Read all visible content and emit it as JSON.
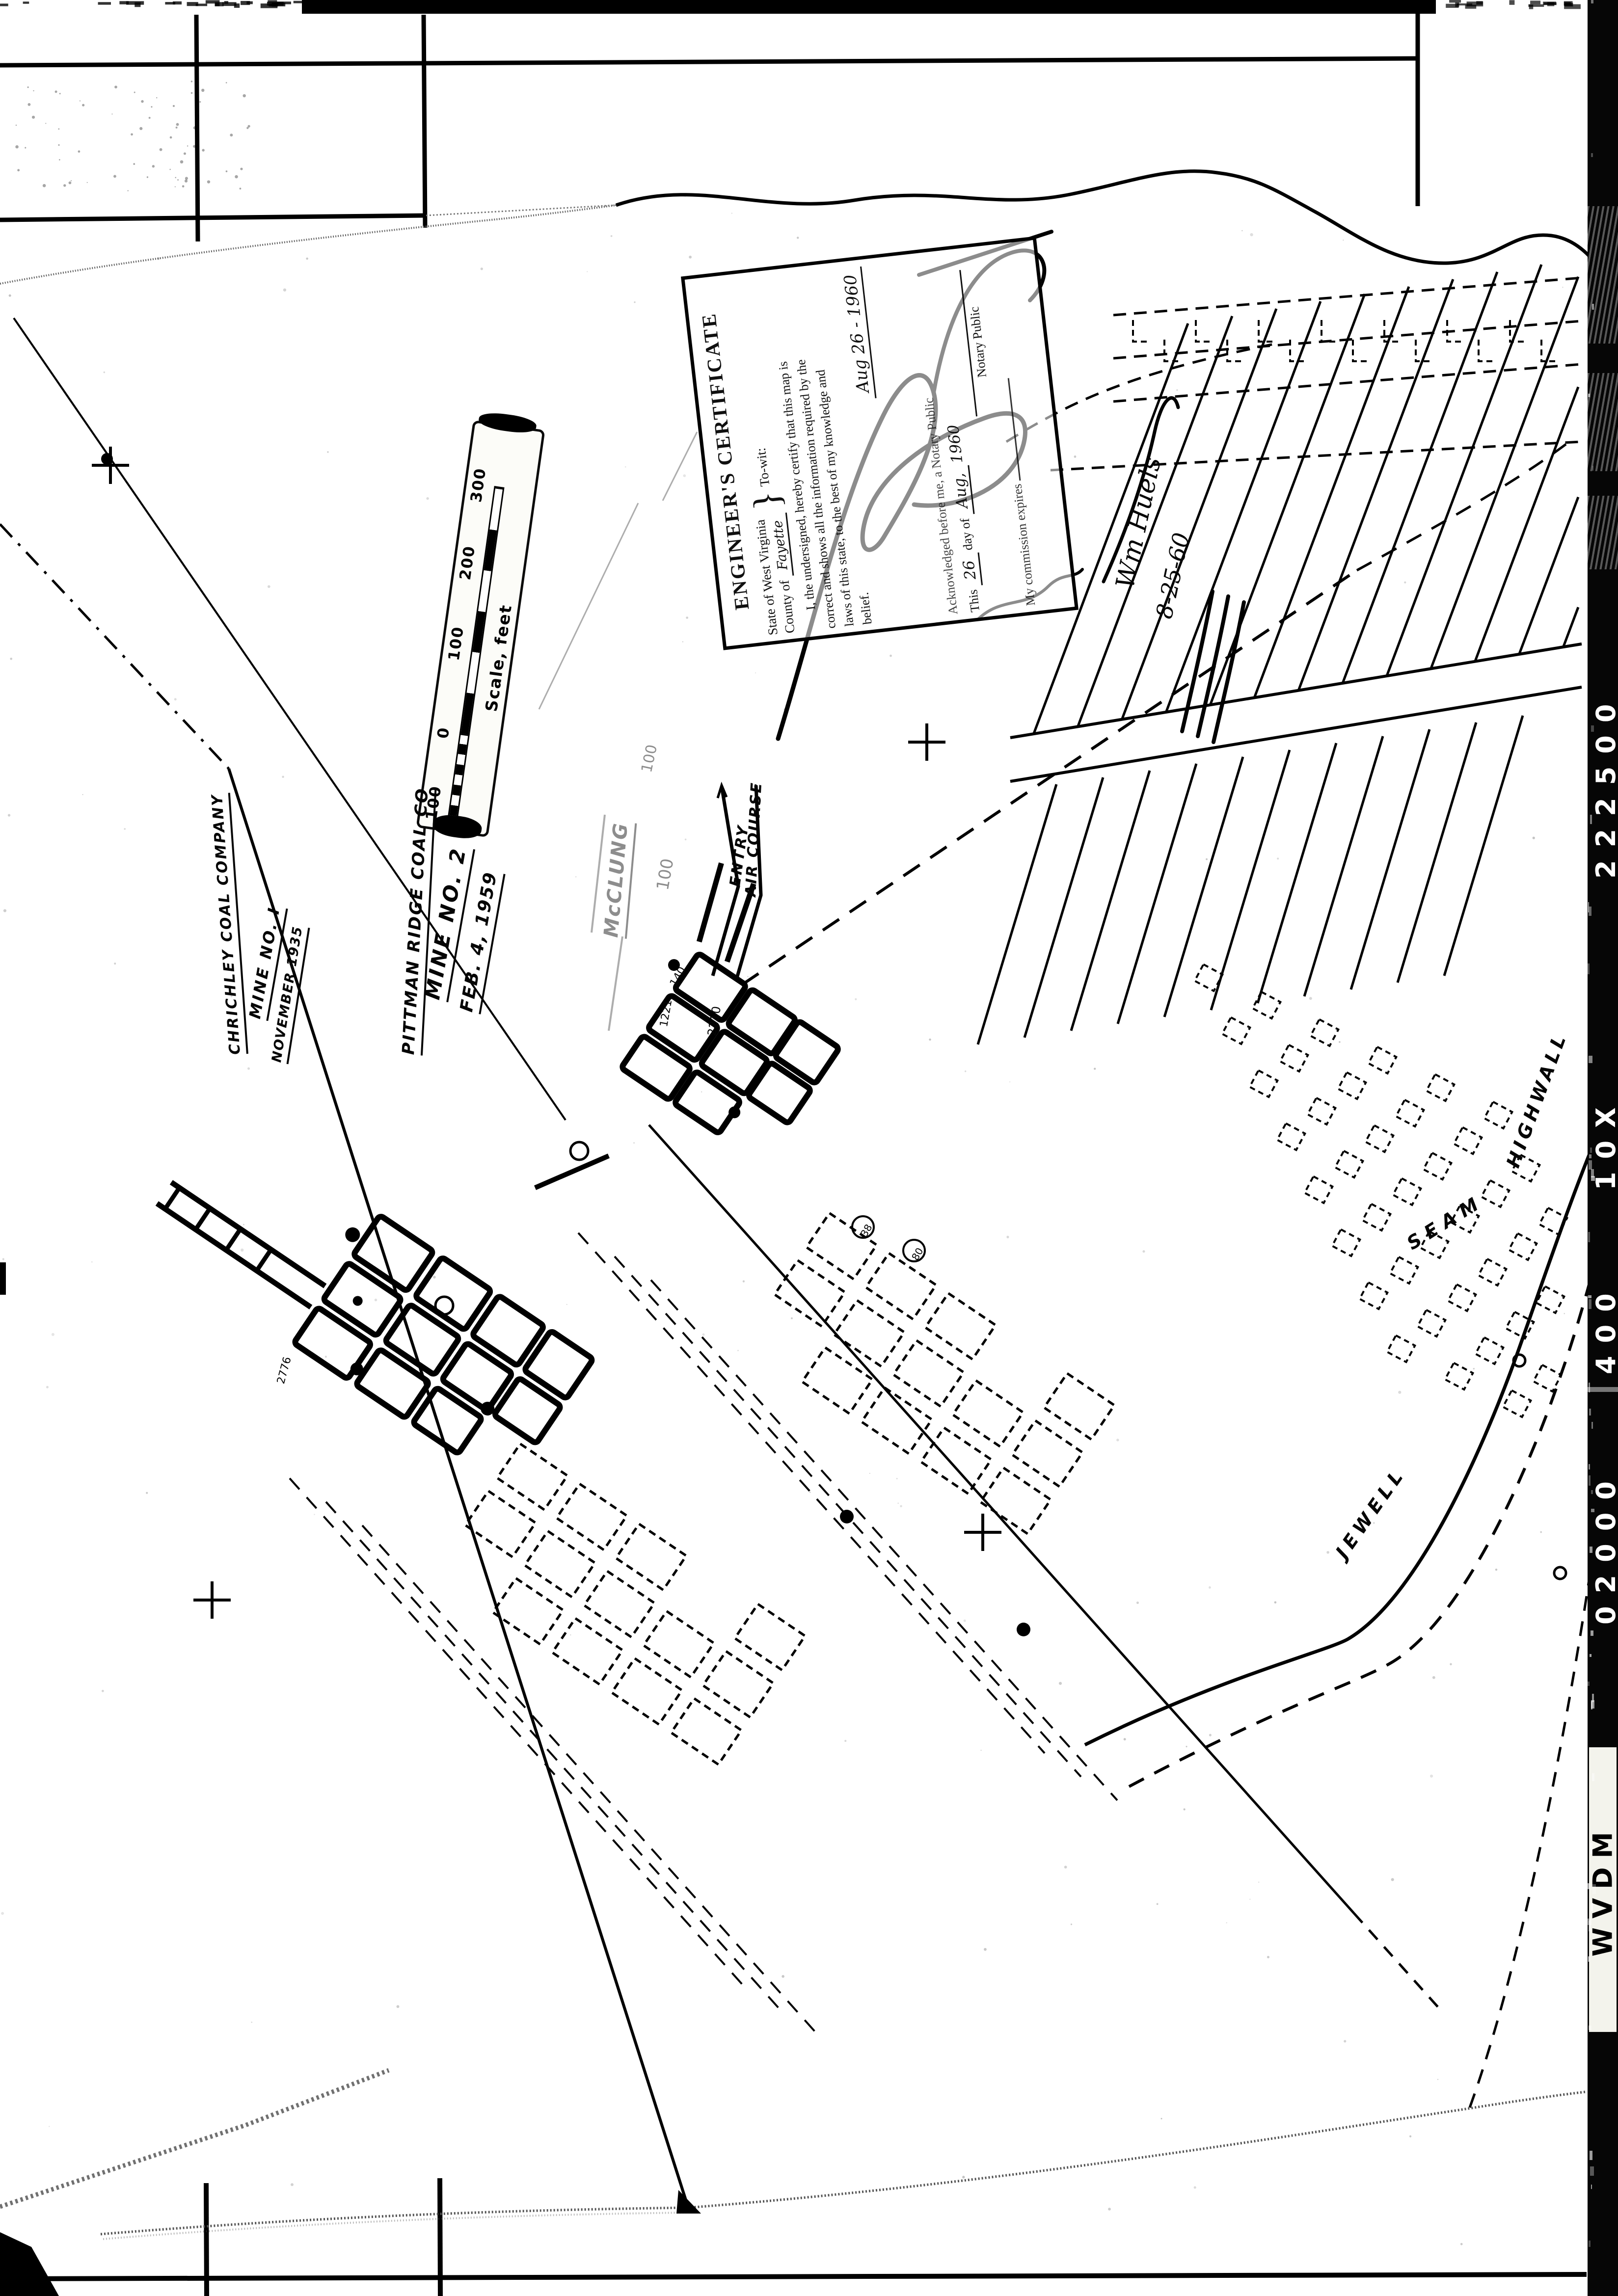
{
  "colors": {
    "paper": "#ffffff",
    "ink": "#000000",
    "film_strip_bg": "#060606"
  },
  "film_strip": {
    "brand": "WVDM",
    "codes": [
      "222500",
      "10X",
      "400",
      "02000"
    ]
  },
  "certificate": {
    "title": "ENGINEER'S CERTIFICATE",
    "state_label": "State of West Virginia",
    "brace": "}",
    "towit": "To-wit:",
    "county_label": "County of",
    "county_value": "Fayette",
    "body": [
      "I, the undersigned, hereby certify that this map is",
      "correct and shows all the information required by the",
      "laws of this state, to the best of my knowledge and",
      "belief."
    ],
    "signed_date": "Aug 26 - 1960",
    "acknowledged": "Acknowledged before me, a Notary Public",
    "day_line_prefix": "This",
    "day_value": "26",
    "day_line_mid": "day of",
    "month_value": "Aug,",
    "year_value": "1960",
    "notary_label": "Notary Public",
    "commission_label": "My commission expires"
  },
  "margin_notes": {
    "name": "Wm Huels",
    "date": "8-25-60"
  },
  "scale_bar": {
    "caption": "Scale, feet",
    "ticks": [
      "100",
      "0",
      "100",
      "200",
      "300"
    ]
  },
  "titles": {
    "mine1": {
      "company": "CHRICHLEY COAL COMPANY",
      "mine": "MINE NO. I",
      "date": "NOVEMBER 1935"
    },
    "mine2": {
      "company": "PITTMAN RIDGE COAL CO",
      "mine": "MINE NO. 2",
      "date": "FEB. 4, 1959"
    },
    "faint": {
      "line1": "McCLUNG",
      "note1": "100",
      "note2": "100"
    }
  },
  "map_labels": {
    "entry": "ENTRY",
    "air_course": "AIR COURSE",
    "seam": [
      "JEWELL",
      "SEAM",
      "HIGHWALL"
    ],
    "stations": [
      "2210",
      "1221",
      "140",
      "2776",
      "38",
      "80"
    ]
  }
}
